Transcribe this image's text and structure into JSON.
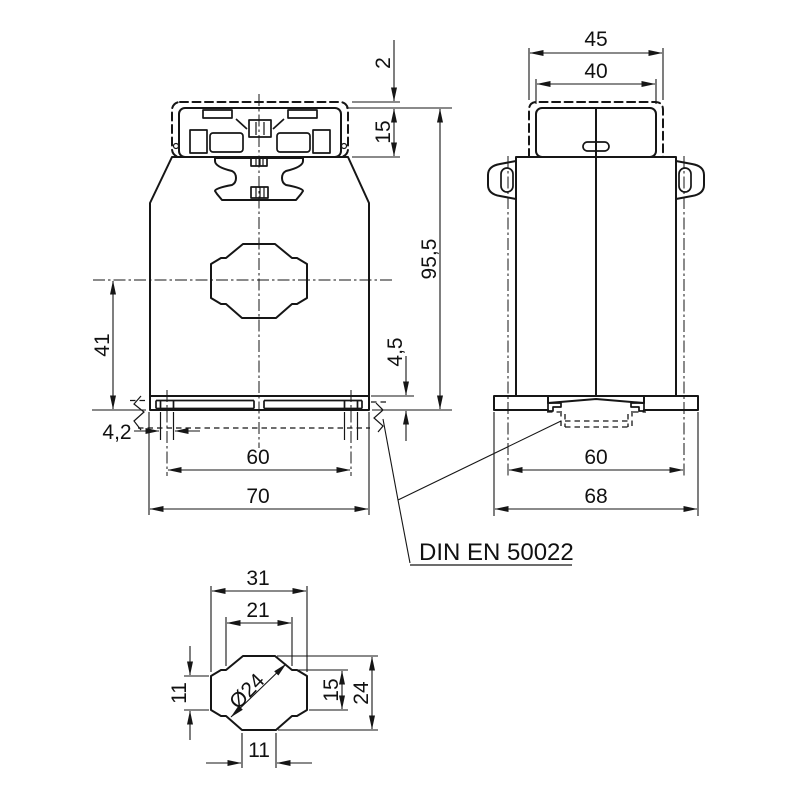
{
  "front_view": {
    "cover_gap": "2",
    "terminal_height": "15",
    "total_height": "95,5",
    "center_to_base": "41",
    "foot_height": "4,5",
    "slot_width": "4,2",
    "hole_spacing": "60",
    "base_width": "70"
  },
  "side_view": {
    "cover_width": "45",
    "head_width": "40",
    "rail_hole_spacing": "60",
    "base_width": "68"
  },
  "detail_view": {
    "opening_width": "31",
    "top_slot_width": "21",
    "diameter": "Ø24",
    "band_height": "11",
    "pocket_height": "15",
    "opening_height": "24",
    "bottom_slot_width": "11"
  },
  "labels": {
    "din_rail_standard": "DIN EN 50022"
  },
  "colors": {
    "line": "#161616",
    "background": "#ffffff"
  }
}
